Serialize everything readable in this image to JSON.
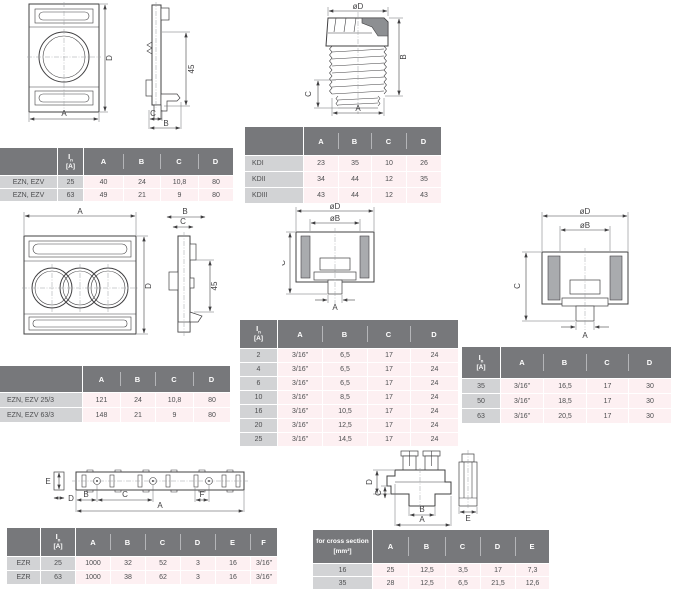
{
  "colors": {
    "header_bg": "#77787b",
    "label_bg": "#d2d3d5",
    "row_bg": "#fdf0f2",
    "line": "#414042",
    "shade": "#a9abae"
  },
  "in_header": {
    "sym": "I",
    "sub": "n",
    "unit": "[A]"
  },
  "drawings": {
    "ezn_front": {
      "dim_a": "A",
      "dim_d": "D"
    },
    "ezn_side": {
      "dim_45": "45",
      "dim_c": "C",
      "dim_b": "B"
    },
    "kd_gland": {
      "dim_od": "øD",
      "dim_a": "A",
      "dim_b": "B",
      "dim_c": "C"
    },
    "ezn3_front": {
      "dim_a": "A",
      "dim_d": "D"
    },
    "ezn3_side": {
      "dim_b": "B",
      "dim_c": "C",
      "dim_45": "45"
    },
    "cup_small": {
      "dim_od": "øD",
      "dim_ob": "øB",
      "dim_a": "A",
      "dim_c": "C"
    },
    "cup_large": {
      "dim_od": "øD",
      "dim_ob": "øB",
      "dim_a": "A",
      "dim_c": "C"
    },
    "rail": {
      "dim_a": "A",
      "dim_b": "B",
      "dim_c": "C",
      "dim_d": "D",
      "dim_e": "E",
      "dim_f": "F"
    },
    "terminal": {
      "dim_a": "A",
      "dim_b": "B",
      "dim_c": "C",
      "dim_d": "D",
      "dim_e": "E"
    }
  },
  "tables": {
    "ezn_ezv": {
      "columns": [
        "A",
        "B",
        "C",
        "D"
      ],
      "rows": [
        {
          "name": "EZN, EZV",
          "in": "25",
          "values": [
            "40",
            "24",
            "10,8",
            "80"
          ]
        },
        {
          "name": "EZN, EZV",
          "in": "63",
          "values": [
            "49",
            "21",
            "9",
            "80"
          ]
        }
      ]
    },
    "kd": {
      "columns": [
        "A",
        "B",
        "C",
        "D"
      ],
      "rows": [
        {
          "name": "KDI",
          "values": [
            "23",
            "35",
            "10",
            "26"
          ]
        },
        {
          "name": "KDII",
          "values": [
            "34",
            "44",
            "12",
            "35"
          ]
        },
        {
          "name": "KDIII",
          "values": [
            "43",
            "44",
            "12",
            "43"
          ]
        }
      ]
    },
    "ezn_ezv_3": {
      "columns": [
        "A",
        "B",
        "C",
        "D"
      ],
      "rows": [
        {
          "name": "EZN, EZV 25/3",
          "values": [
            "121",
            "24",
            "10,8",
            "80"
          ]
        },
        {
          "name": "EZN, EZV 63/3",
          "values": [
            "148",
            "21",
            "9",
            "80"
          ]
        }
      ]
    },
    "inserts_small": {
      "columns": [
        "A",
        "B",
        "C",
        "D"
      ],
      "rows": [
        {
          "in": "2",
          "values": [
            "3/16”",
            "6,5",
            "17",
            "24"
          ]
        },
        {
          "in": "4",
          "values": [
            "3/16”",
            "6,5",
            "17",
            "24"
          ]
        },
        {
          "in": "6",
          "values": [
            "3/16”",
            "6,5",
            "17",
            "24"
          ]
        },
        {
          "in": "10",
          "values": [
            "3/16”",
            "8,5",
            "17",
            "24"
          ]
        },
        {
          "in": "16",
          "values": [
            "3/16”",
            "10,5",
            "17",
            "24"
          ]
        },
        {
          "in": "20",
          "values": [
            "3/16”",
            "12,5",
            "17",
            "24"
          ]
        },
        {
          "in": "25",
          "values": [
            "3/16”",
            "14,5",
            "17",
            "24"
          ]
        }
      ]
    },
    "inserts_large": {
      "columns": [
        "A",
        "B",
        "C",
        "D"
      ],
      "rows": [
        {
          "in": "35",
          "values": [
            "3/16”",
            "16,5",
            "17",
            "30"
          ]
        },
        {
          "in": "50",
          "values": [
            "3/16”",
            "18,5",
            "17",
            "30"
          ]
        },
        {
          "in": "63",
          "values": [
            "3/16”",
            "20,5",
            "17",
            "30"
          ]
        }
      ]
    },
    "ezr": {
      "columns": [
        "A",
        "B",
        "C",
        "D",
        "E",
        "F"
      ],
      "rows": [
        {
          "name": "EZR",
          "in": "25",
          "values": [
            "1000",
            "32",
            "52",
            "3",
            "16",
            "3/16”"
          ]
        },
        {
          "name": "EZR",
          "in": "63",
          "values": [
            "1000",
            "38",
            "62",
            "3",
            "16",
            "3/16”"
          ]
        }
      ]
    },
    "cross_section": {
      "header_line1": "for cross section",
      "header_line2": "[mm²]",
      "columns": [
        "A",
        "B",
        "C",
        "D",
        "E"
      ],
      "rows": [
        {
          "name": "16",
          "values": [
            "25",
            "12,5",
            "3,5",
            "17",
            "7,3"
          ]
        },
        {
          "name": "35",
          "values": [
            "28",
            "12,5",
            "6,5",
            "21,5",
            "12,6"
          ]
        }
      ]
    }
  }
}
